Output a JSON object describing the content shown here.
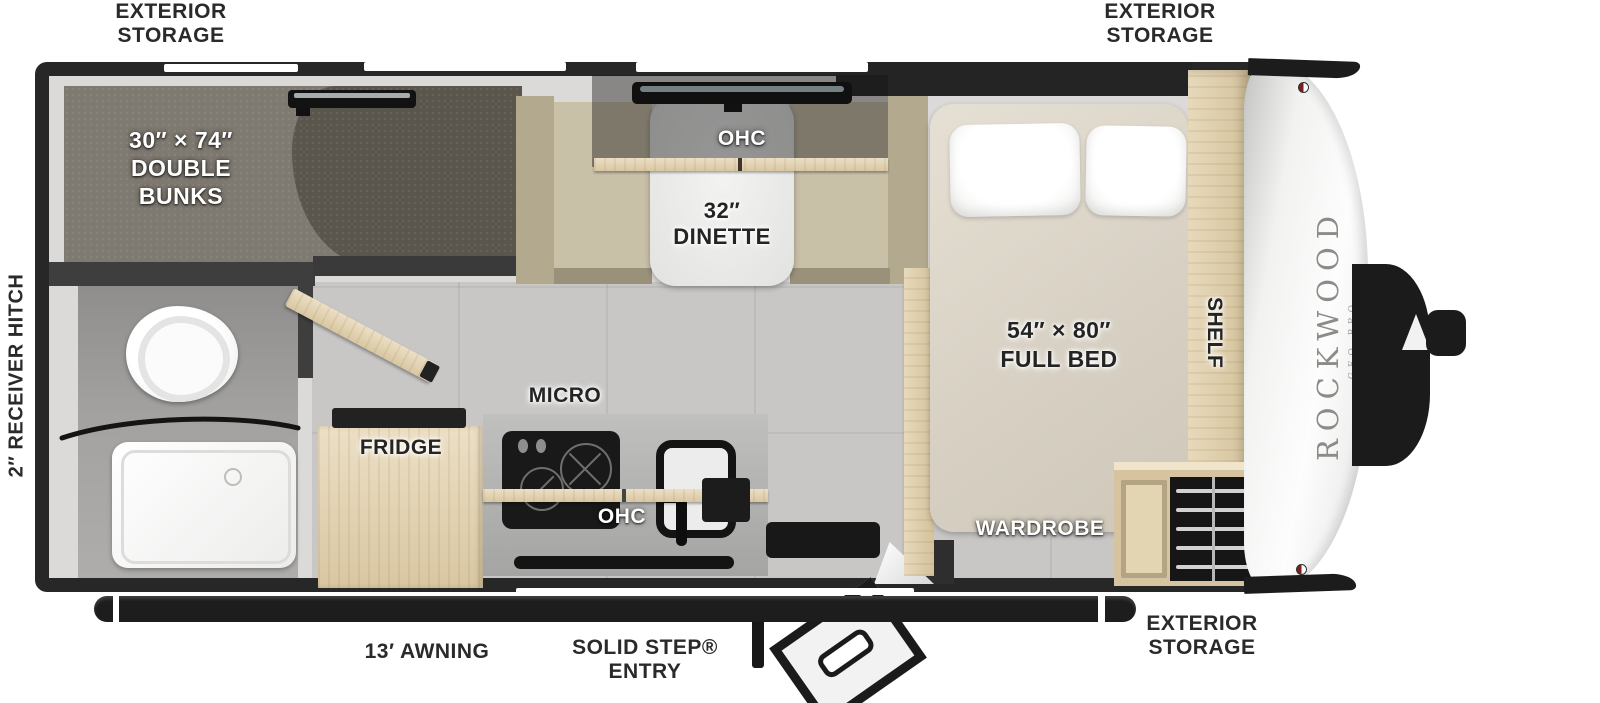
{
  "title": "Rockwood Geo Pro Travel Trailer Floorplan",
  "brand": {
    "name": "ROCKWOOD",
    "model": "GEO PRO"
  },
  "exterior_labels": {
    "storage_top_left": "EXTERIOR\nSTORAGE",
    "storage_top_right": "EXTERIOR\nSTORAGE",
    "storage_bottom_right": "EXTERIOR\nSTORAGE",
    "awning": "13′ AWNING",
    "entry": "SOLID STEP®\nENTRY",
    "receiver_hitch": "2″ RECEIVER HITCH"
  },
  "interior_labels": {
    "double_bunks": "30″ × 74″\nDOUBLE\nBUNKS",
    "dinette": "32″\nDINETTE",
    "dinette_ohc": "OHC",
    "kitchen_ohc": "OHC",
    "microwave": "MICRO",
    "fridge": "FRIDGE",
    "full_bed": "54″ × 80″\nFULL BED",
    "wardrobe": "WARDROBE",
    "shelf": "SHELF"
  },
  "colors": {
    "trailer_wall": "#272727",
    "interior_wall": "#dbdad8",
    "floor_tile": "#c8c7c5",
    "carpet_light": "#7f7a71",
    "carpet_dark": "#5a564e",
    "bench_tan": "#c9c0a8",
    "wood_light": "#e9dcc0",
    "mattress_cream": "#ded7c9",
    "brand_gray": "#8d8b88"
  }
}
